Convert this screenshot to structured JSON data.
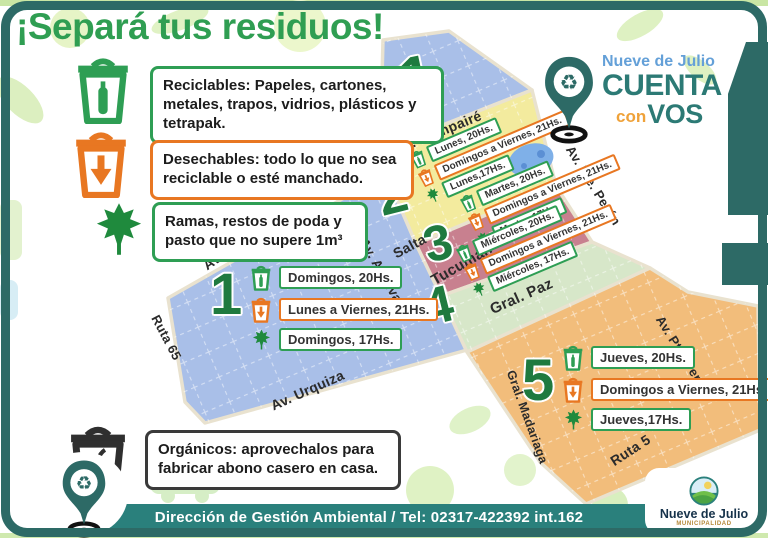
{
  "title": "¡Separá tus residuos!",
  "brand": {
    "region": "Nueve de Julio",
    "cuenta": "CUENTA",
    "con": "con",
    "vos": "VOS"
  },
  "legend": {
    "reciclables": "Reciclables: Papeles, cartones, metales, trapos, vidrios, plásticos y tetrapak.",
    "desechables": "Desechables: todo lo que no sea reciclable o esté manchado.",
    "ramas": "Ramas, restos de poda y pasto que no supere 1m³",
    "organicos": "Orgánicos: aprovechalos para fabricar abono casero en casa."
  },
  "zones": [
    {
      "number": "1",
      "color": "#a9bfe8",
      "schedule": [
        {
          "icon": "recycle-bin",
          "text": "Domingos, 20Hs."
        },
        {
          "icon": "trash-bin",
          "text": "Lunes a Viernes, 21Hs."
        },
        {
          "icon": "leaf",
          "text": "Domingos, 17Hs."
        }
      ]
    },
    {
      "number": "2",
      "color": "#f3eb9e",
      "schedule": [
        {
          "icon": "recycle-bin",
          "text": "Lunes, 20Hs."
        },
        {
          "icon": "trash-bin",
          "text": "Domingos a Viernes, 21Hs."
        },
        {
          "icon": "leaf",
          "text": "Lunes,17Hs."
        }
      ]
    },
    {
      "number": "3",
      "color": "#c8808f",
      "schedule": [
        {
          "icon": "recycle-bin",
          "text": "Martes, 20Hs."
        },
        {
          "icon": "trash-bin",
          "text": "Domingos a Viernes, 21Hs."
        },
        {
          "icon": "leaf",
          "text": "Martes,17Hs."
        }
      ]
    },
    {
      "number": "4",
      "color": "#d7e7c9",
      "schedule": [
        {
          "icon": "recycle-bin",
          "text": "Miércoles, 20Hs."
        },
        {
          "icon": "trash-bin",
          "text": "Domingos a Viernes, 21Hs."
        },
        {
          "icon": "leaf",
          "text": "Miércoles, 17Hs."
        }
      ]
    },
    {
      "number": "5",
      "color": "#f2bd7b",
      "schedule": [
        {
          "icon": "recycle-bin",
          "text": "Jueves, 20Hs."
        },
        {
          "icon": "trash-bin",
          "text": "Domingos a Viernes, 21Hs."
        },
        {
          "icon": "leaf",
          "text": "Jueves,17Hs."
        }
      ]
    }
  ],
  "streets": {
    "q_martin": "Q. Martin",
    "compaire": "Av. Compairé",
    "peron": "Av. Pte. Perón",
    "salta": "Salta",
    "tucuman": "Tucuman",
    "alvarez": "Av. A. Álvarez",
    "gral_paz": "Gral. Paz",
    "urquiza": "Av. Urquiza",
    "ruta65": "Ruta 65",
    "madariaga": "Gral. Madariaga",
    "ruta5": "Ruta 5"
  },
  "footer": {
    "text": "Dirección de Gestión Ambiental / Tel: 02317-422392 int.162"
  },
  "municipality": {
    "name": "Nueve de Julio",
    "sub": "MUNICIPALIDAD"
  },
  "colors": {
    "frame": "#2d6a66",
    "footer_bar": "#2a807c",
    "title_green": "#2f9e52",
    "zone_number_green": "#1f7a3f",
    "legend_green": "#2e9e54",
    "legend_orange": "#e87722",
    "organics_black": "#2f2f2f",
    "brand_blue": "#64a0d8",
    "brand_teal": "#2c7a75",
    "brand_orange": "#efa23a",
    "lake_blue": "#7fb0e8",
    "map_road": "#e9e2cf"
  }
}
